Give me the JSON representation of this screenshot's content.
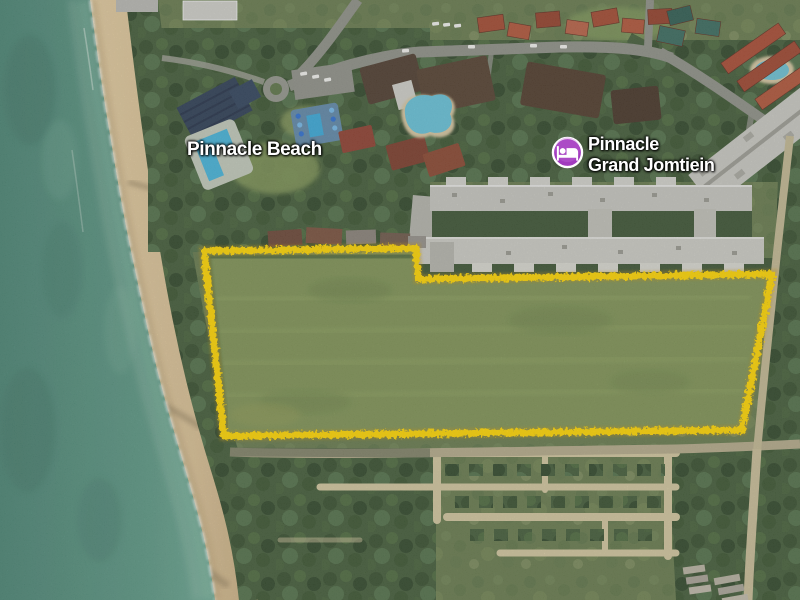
{
  "map": {
    "labels": {
      "beach_resort": "Pinnacle Beach",
      "condo_line1": "Pinnacle",
      "condo_line2": "Grand Jomtiein"
    },
    "marker": {
      "type": "lodging",
      "color": "#A13BBE",
      "ring_color": "#FFFFFF"
    },
    "parcel": {
      "outline_color": "#FFD600"
    },
    "palette": {
      "ocean": "#5C9884",
      "sand": "#D9C094",
      "field_grass": "#7F9355",
      "forest": "#435C38"
    }
  }
}
